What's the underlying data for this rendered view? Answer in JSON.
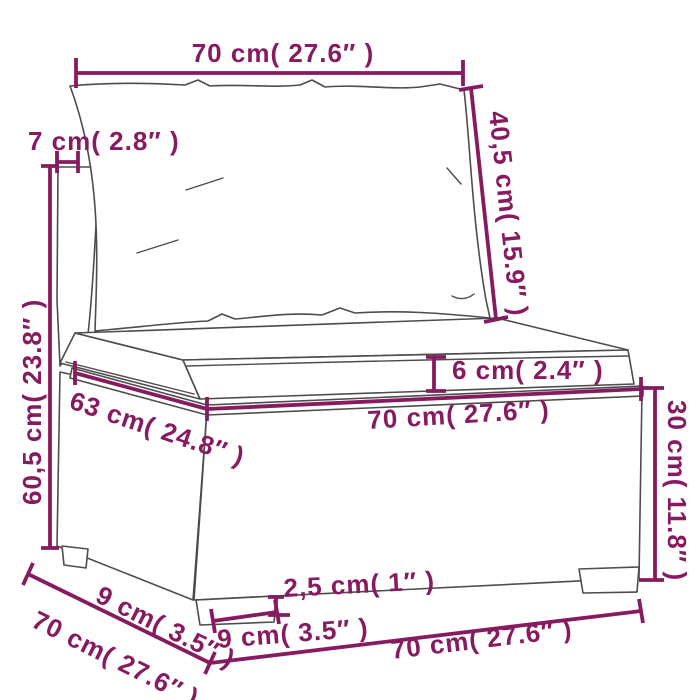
{
  "figure": {
    "title": "Patio rattan sofa section dimension diagram",
    "type": "product-dimension-diagram",
    "background_color": "#ffffff",
    "lineart_color": "#4d4d4d",
    "dimension_color": "#871b60"
  },
  "dimensions": {
    "top_width": {
      "label": "70 cm( 27.6″  )",
      "value_cm": 70,
      "value_in": 27.6
    },
    "backrest_thickness": {
      "label": "7 cm( 2.8″  )",
      "value_cm": 7,
      "value_in": 2.8
    },
    "back_cushion_height": {
      "label": "40,5 cm( 15.9″  )",
      "value_cm": 40.5,
      "value_in": 15.9
    },
    "total_height": {
      "label": "60,5 cm( 23.8″  )",
      "value_cm": 60.5,
      "value_in": 23.8
    },
    "seat_cushion_thickness": {
      "label": "6 cm( 2.4″  )",
      "value_cm": 6,
      "value_in": 2.4
    },
    "seat_depth": {
      "label": "63 cm( 24.8″  )",
      "value_cm": 63,
      "value_in": 24.8
    },
    "seat_width": {
      "label": "70 cm( 27.6″  )",
      "value_cm": 70,
      "value_in": 27.6
    },
    "base_height": {
      "label": "30 cm( 11.8″  )",
      "value_cm": 30,
      "value_in": 11.8
    },
    "side_inset": {
      "label": "9 cm( 3.5″  )",
      "value_cm": 9,
      "value_in": 3.5
    },
    "floor_depth": {
      "label": "70 cm( 27.6″  )",
      "value_cm": 70,
      "value_in": 27.6
    },
    "leg_height": {
      "label": "2,5 cm( 1″  )",
      "value_cm": 2.5,
      "value_in": 1
    },
    "leg_width": {
      "label": "9 cm( 3.5″  )",
      "value_cm": 9,
      "value_in": 3.5
    },
    "floor_width": {
      "label": "70 cm( 27.6″  )",
      "value_cm": 70,
      "value_in": 27.6
    }
  }
}
